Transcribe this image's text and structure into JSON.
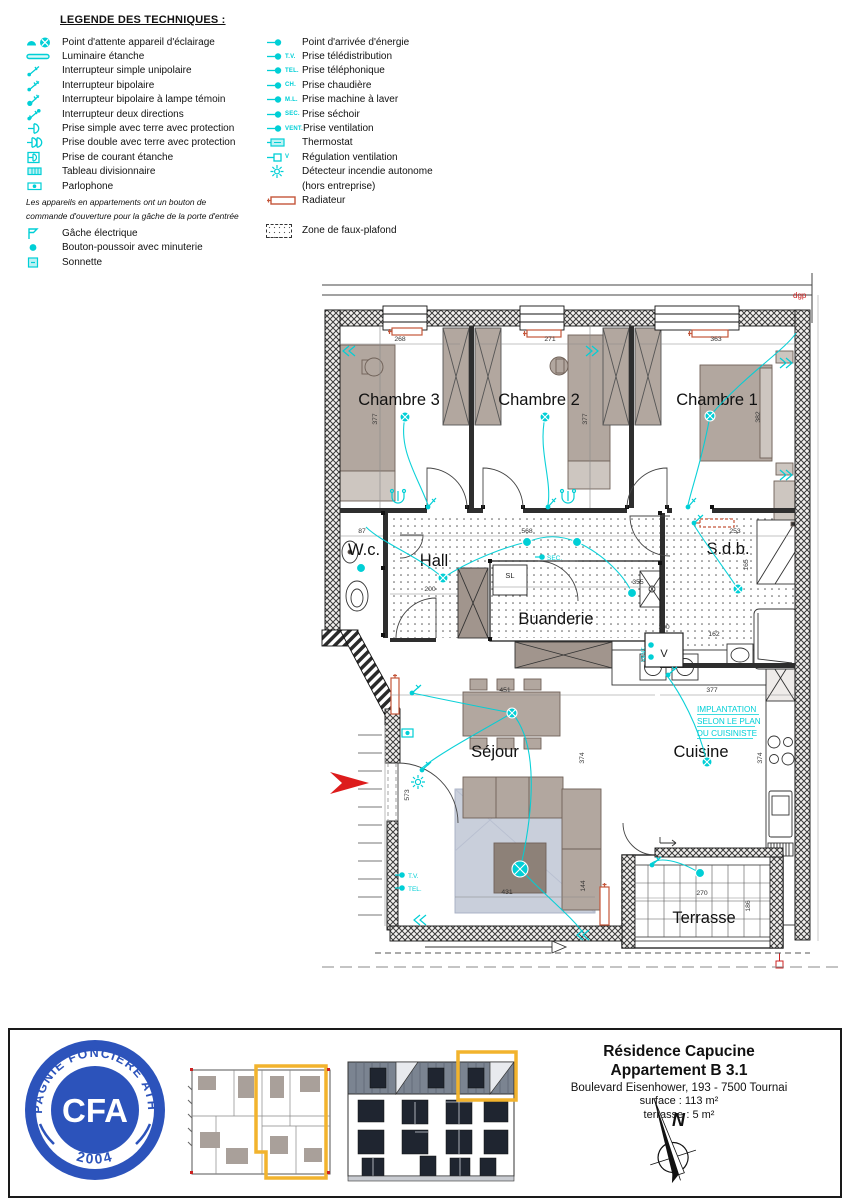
{
  "legend": {
    "title": "LEGENDE DES TECHNIQUES :",
    "col1": [
      {
        "label": "Point d'attente appareil d'éclairage"
      },
      {
        "label": "Luminaire étanche"
      },
      {
        "label": "Interrupteur simple unipolaire"
      },
      {
        "label": "Interrupteur bipolaire"
      },
      {
        "label": "Interrupteur bipolaire à lampe témoin"
      },
      {
        "label": "Interrupteur deux directions"
      },
      {
        "label": "Prise simple avec terre avec protection"
      },
      {
        "label": "Prise double avec terre avec protection"
      },
      {
        "label": "Prise de courant étanche"
      },
      {
        "label": "Tableau divisionnaire"
      },
      {
        "label": "Parlophone"
      },
      {
        "label": "Gâche électrique"
      },
      {
        "label": "Bouton-poussoir avec minuterie"
      },
      {
        "label": "Sonnette"
      }
    ],
    "note_line1": "Les appareils en appartements ont un bouton de",
    "note_line2": "commande d'ouverture pour la gâche de la porte d'entrée",
    "col2": [
      {
        "label": "Point d'arrivée d'énergie",
        "tag": ""
      },
      {
        "label": "Prise télédistribution",
        "tag": "T.V."
      },
      {
        "label": "Prise téléphonique",
        "tag": "TEL."
      },
      {
        "label": "Prise chaudière",
        "tag": "CH."
      },
      {
        "label": "Prise machine à laver",
        "tag": "M.L."
      },
      {
        "label": "Prise séchoir",
        "tag": "SEC."
      },
      {
        "label": "Prise ventilation",
        "tag": "VENT."
      },
      {
        "label": "Thermostat",
        "tag": ""
      },
      {
        "label": "Régulation ventilation",
        "tag": "V"
      },
      {
        "label": "Détecteur incendie autonome",
        "label2": "(hors entreprise)",
        "tag": ""
      },
      {
        "label": "Radiateur",
        "tag": ""
      },
      {
        "label": "Zone de faux-plafond",
        "tag": ""
      }
    ]
  },
  "plan": {
    "rooms": {
      "chambre3": "Chambre 3",
      "chambre2": "Chambre 2",
      "chambre1": "Chambre 1",
      "wc": "W.c.",
      "hall": "Hall",
      "sdb": "S.d.b.",
      "buanderie": "Buanderie",
      "sejour": "Séjour",
      "cuisine": "Cuisine",
      "terrasse": "Terrasse"
    },
    "labels": {
      "sl": "SL",
      "v": "V",
      "vent": "VENT.",
      "sec": "SEC.",
      "tv": "T.V.",
      "tel": "TEL.",
      "dgp": "dgp",
      "impl1": "IMPLANTATION",
      "impl2": "SELON LE PLAN",
      "impl3": "DU CUISINISTE"
    },
    "dims": {
      "d268": "268",
      "d271": "271",
      "d363": "363",
      "d377a": "377",
      "d377b": "377",
      "d382": "382",
      "d87": "87",
      "d568": "568",
      "d253": "253",
      "d165": "165",
      "d200": "200",
      "d355": "355",
      "d100": "100",
      "d162": "162",
      "d451": "451",
      "d377c": "377",
      "d374a": "374",
      "d374b": "374",
      "d573": "573",
      "d431": "431",
      "d144": "144",
      "d270": "270",
      "d186": "186"
    }
  },
  "titleblock": {
    "project": "Résidence Capucine",
    "unit": "Appartement B 3.1",
    "address": "Boulevard Eisenhower, 193 - 7500 Tournai",
    "surface": "surface : 113 m²",
    "terrace": "terrasse : 5 m²",
    "north_letter": "N"
  },
  "logo": {
    "arc_text": "COMPAGNIE FONCIERE ATHOISE",
    "acronym": "CFA",
    "year": "2004"
  },
  "colors": {
    "cyan": "#00cfd6",
    "radiator_orange": "#c4563a",
    "accent_red": "#dd1c1c",
    "logo_blue": "#2c53bb",
    "highlight_yellow": "#f2b32d"
  }
}
